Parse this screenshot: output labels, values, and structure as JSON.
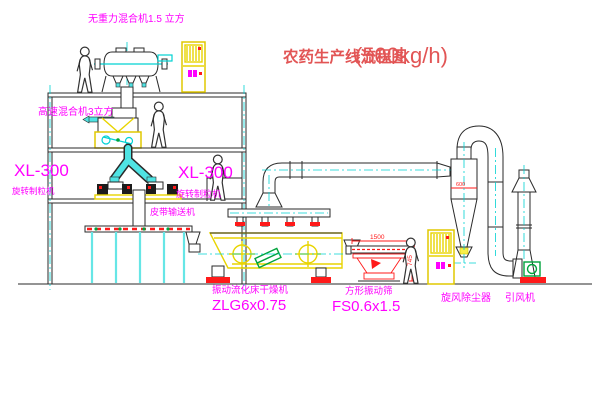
{
  "title": {
    "main": "农药生产线流程图",
    "capacity": "(500kg/h)"
  },
  "equipment_labels": {
    "gravity_mixer": "无重力混合机1.5 立方",
    "high_speed_mixer": "高速混合机3立方",
    "granulator_left_model": "XL-300",
    "granulator_left_name": "旋转制粒机",
    "granulator_right_model": "XL-300",
    "granulator_right_name": "旋转制粒机",
    "belt_conveyor": "皮带输送机",
    "fluid_bed_dryer_name": "振动流化床干燥机",
    "fluid_bed_dryer_model": "ZLG6x0.75",
    "square_sieve_name": "方形振动筛",
    "square_sieve_model": "FS0.6x1.5",
    "cyclone": "旋风除尘器",
    "induced_draft_fan": "引风机"
  },
  "dimensions": {
    "sieve_length": "1500",
    "sieve_height": "745",
    "cyclone_diameter": "600"
  },
  "colors": {
    "label_magenta": "#ff00ff",
    "title_red": "#e25555",
    "line_yellow": "#e8d400",
    "line_cyan": "#00d2d2",
    "dim_red": "#ff1a1a",
    "line_black": "#2a2a2a"
  }
}
